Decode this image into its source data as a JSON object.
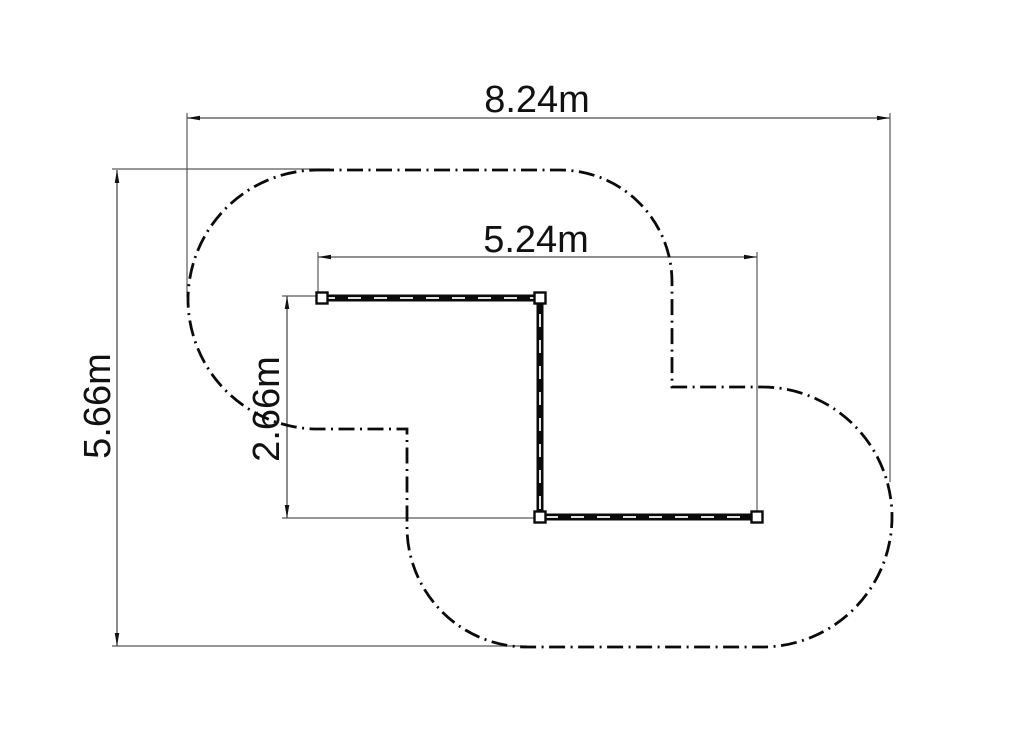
{
  "drawing": {
    "type": "track-plan-technical-drawing",
    "dimensions": {
      "overall_width": "8.24m",
      "overall_height": "5.66m",
      "inner_width": "5.24m",
      "inner_height": "2.66m"
    },
    "colors": {
      "geometry": "#0a0a0a",
      "dimension_lines": "#595959",
      "text": "#111111",
      "background": "#ffffff"
    }
  }
}
